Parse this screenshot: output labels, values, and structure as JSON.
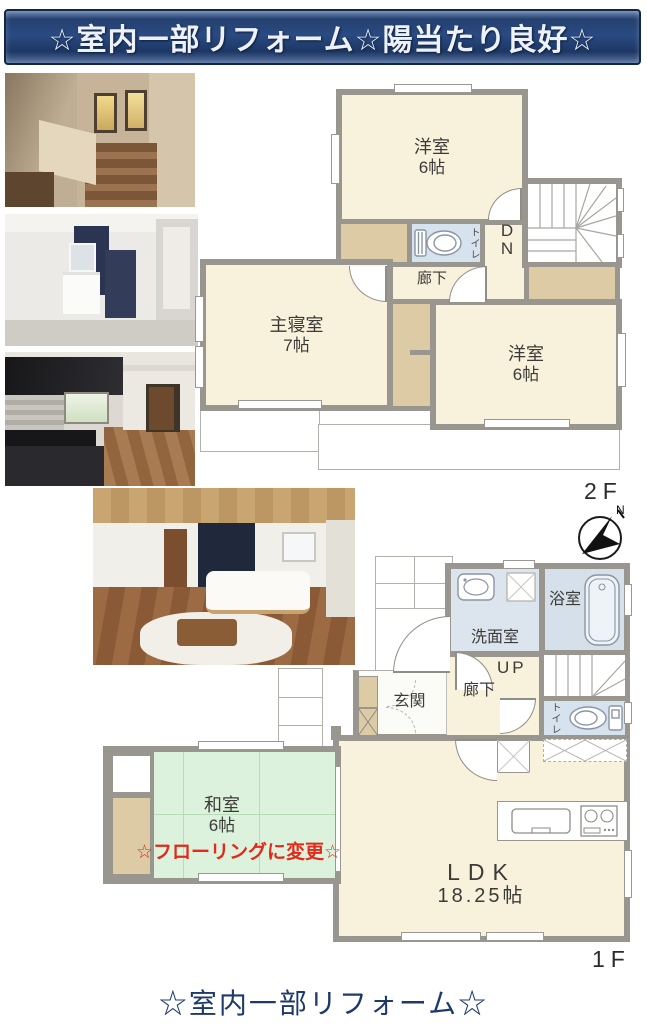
{
  "header": {
    "title": "☆室内一部リフォーム☆陽当たり良好☆"
  },
  "footer": {
    "note": "☆室内一部リフォーム☆"
  },
  "photos": [
    {
      "name": "staircase-photo"
    },
    {
      "name": "washroom-photo"
    },
    {
      "name": "kitchen-photo"
    },
    {
      "name": "living-room-photo"
    }
  ],
  "plan2f": {
    "floor_label": "2F",
    "compass_label": "N",
    "rooms": {
      "yoshitsu_top": {
        "name": "洋室",
        "size": "6帖"
      },
      "master": {
        "name": "主寝室",
        "size": "7帖"
      },
      "yoshitsu_right": {
        "name": "洋室",
        "size": "6帖"
      },
      "corridor": "廊下",
      "toilet": "トイレ",
      "stairs_label": "DN"
    }
  },
  "plan1f": {
    "floor_label": "1F",
    "rooms": {
      "washroom": "洗面室",
      "bath": "浴室",
      "stairs_label": "UP",
      "corridor": "廊下",
      "entrance": "玄関",
      "toilet": "トイレ",
      "washitsu": {
        "name": "和室",
        "size": "6帖"
      },
      "ldk": {
        "name": "LDK",
        "size": "18.25帖"
      },
      "renovation_note": "☆フローリングに変更☆"
    }
  },
  "colors": {
    "room_cream": "#f8f1dc",
    "closet_tan": "#ddcba6",
    "wet_area_blue": "#d6e2ee",
    "tatami_green": "#ddf2dc",
    "wall_gray": "#98968e",
    "header_navy": "#24406f",
    "note_red": "#e2291b",
    "footer_navy": "#1d3a6b"
  }
}
